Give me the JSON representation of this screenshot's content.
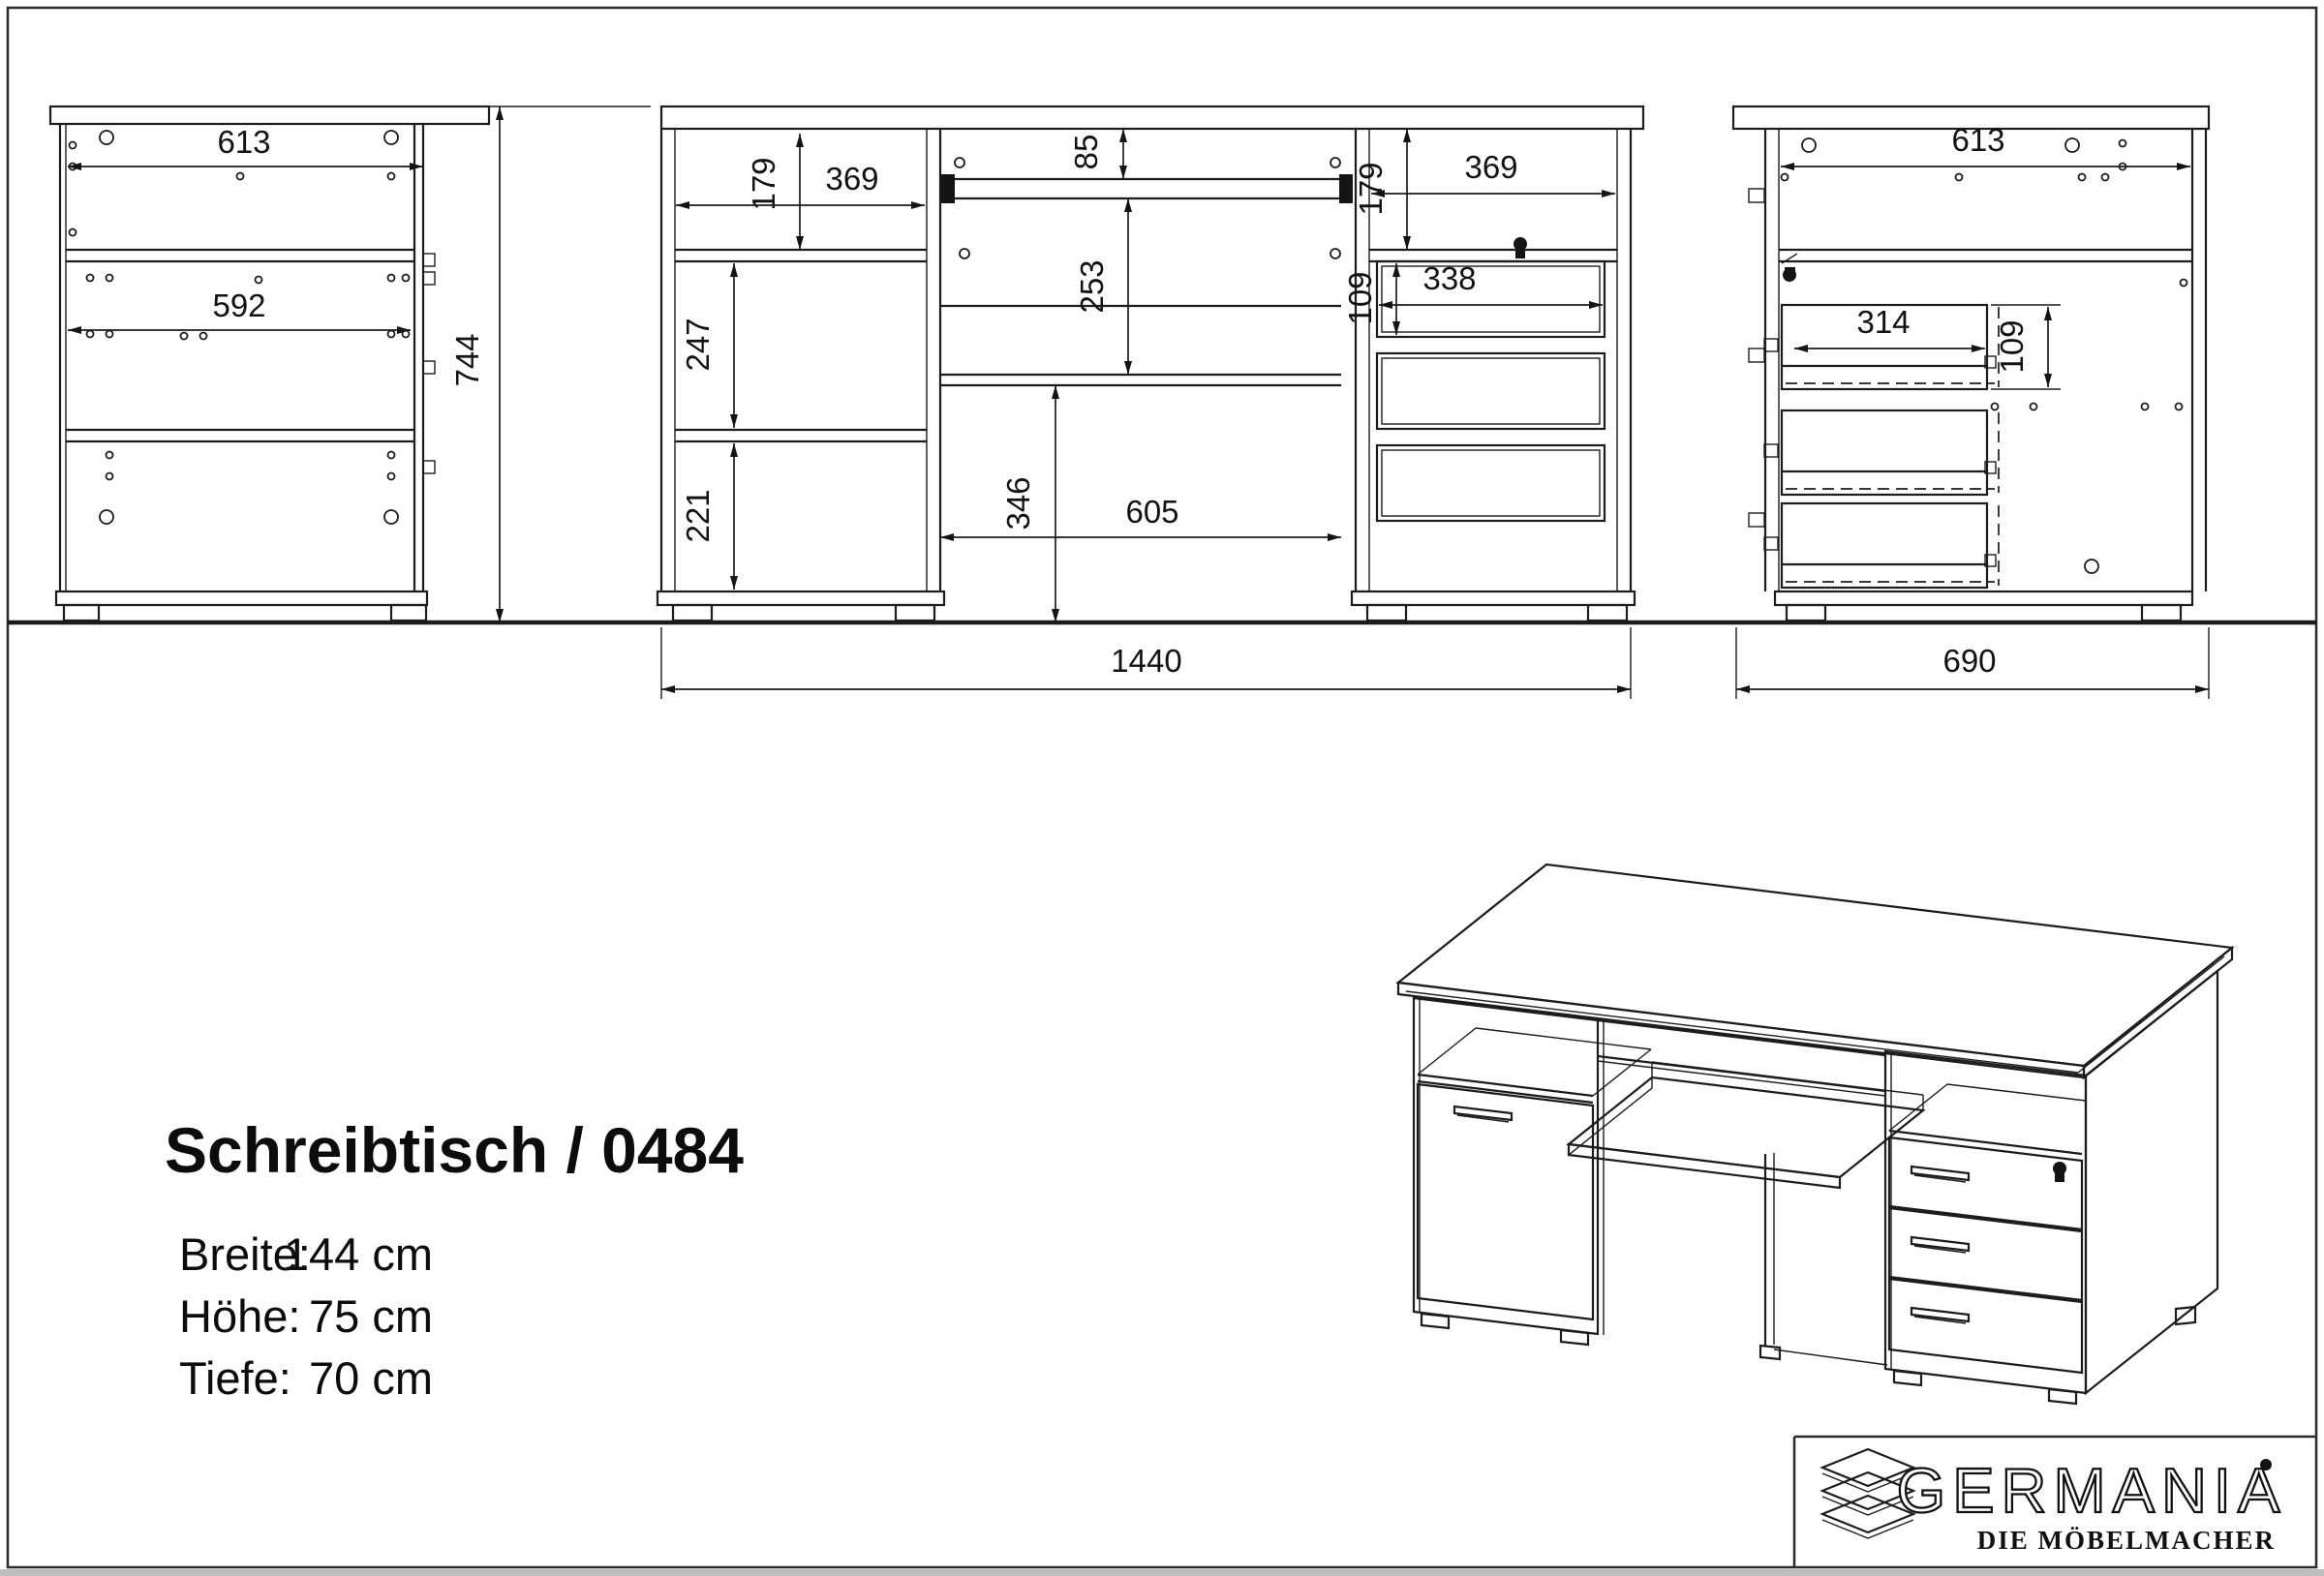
{
  "page": {
    "title_block": {
      "product_title": "Schreibtisch / 0484",
      "specs": [
        {
          "label": "Breite:",
          "value": "144 cm"
        },
        {
          "label": "Höhe:",
          "value": "75 cm"
        },
        {
          "label": "Tiefe:",
          "value": "70 cm"
        }
      ]
    },
    "views": {
      "side_left": {
        "label_top_depth": "613",
        "label_inner_depth": "592",
        "label_height": "744"
      },
      "front": {
        "left_shelf_height": "179",
        "left_inner_width": "369",
        "tray_drop": "85",
        "back_panel_height": "253",
        "compartment_mid_height": "247",
        "compartment_bottom_height": "221",
        "opening_height": "346",
        "opening_width": "605",
        "right_shelf_height": "179",
        "right_inner_width": "369",
        "drawer_height": "109",
        "drawer_width": "338",
        "total_width": "1440"
      },
      "side_right": {
        "label_top_depth": "613",
        "drawer_depth": "314",
        "drawer_height": "109",
        "total_depth": "690"
      }
    },
    "logo": {
      "brand": "GERMANIA",
      "tagline": "DIE MÖBELMACHER"
    }
  }
}
